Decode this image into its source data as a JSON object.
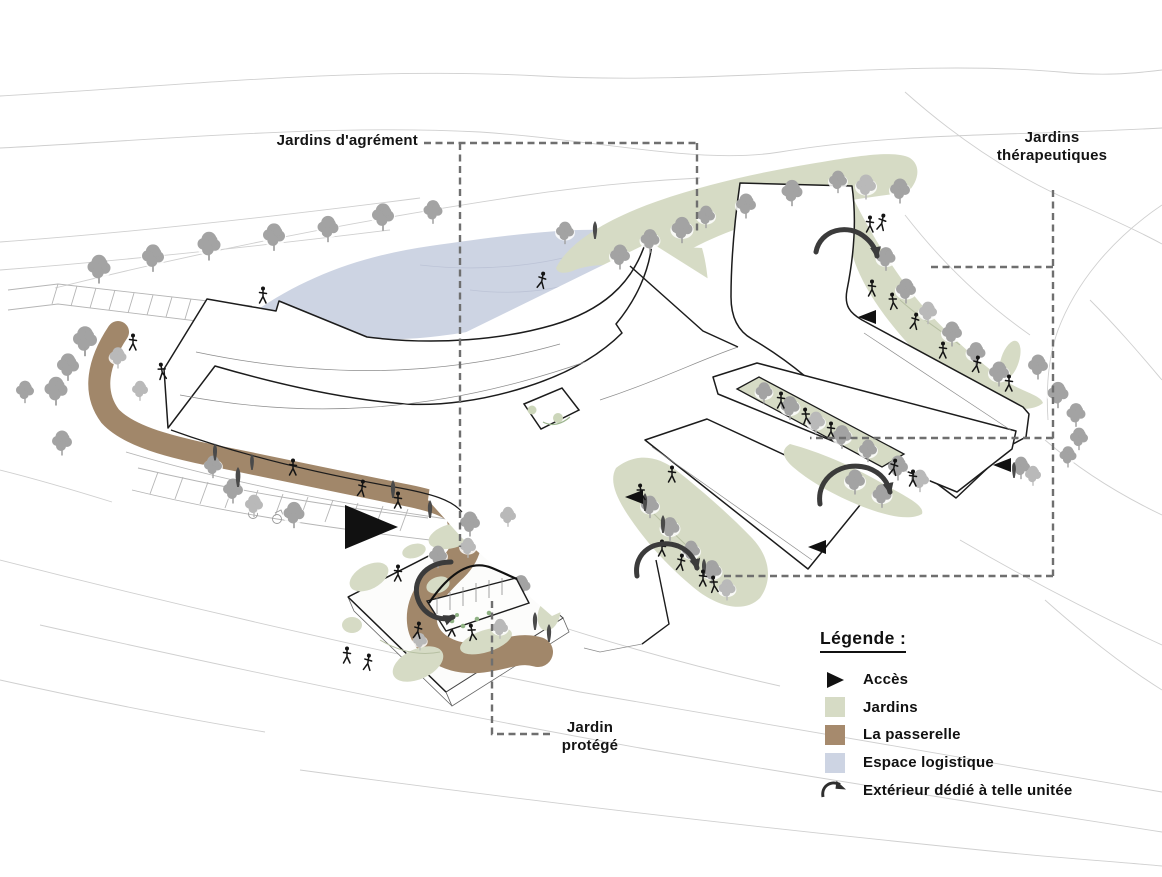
{
  "annotations": {
    "jardins_agrement": {
      "label": "Jardins d'agrément"
    },
    "jardins_therapeutiques": {
      "line1": "Jardins",
      "line2": "thérapeutiques"
    },
    "jardin_protege": {
      "line1": "Jardin",
      "line2": "protégé"
    }
  },
  "legend": {
    "title": "Légende :",
    "items": [
      {
        "label": "Accès",
        "icon": "access-triangle-icon",
        "color": "#111111"
      },
      {
        "label": "Jardins",
        "icon": "garden-color-swatch",
        "color": "#d6dbc5"
      },
      {
        "label": "La passerelle",
        "icon": "walkway-color-swatch",
        "color": "#a68a6d"
      },
      {
        "label": "Espace logistique",
        "icon": "logistics-color-swatch",
        "color": "#cdd4e3"
      },
      {
        "label": "Extérieur dédié à telle unitée",
        "icon": "dedicated-exterior-arrow-icon",
        "color": "#2e2e2e"
      }
    ]
  },
  "colors": {
    "jardins": "#d6dbc5",
    "passerelle": "#a1876a",
    "espace_logistique": "#cdd4e3",
    "access": "#111111",
    "exterior_arrow": "#3b3b3b",
    "building_outline": "#1c1c1c",
    "contour_line": "#cfcfcf",
    "tree": "#a3a3a3",
    "leader_dash": "#6f6f6f"
  }
}
